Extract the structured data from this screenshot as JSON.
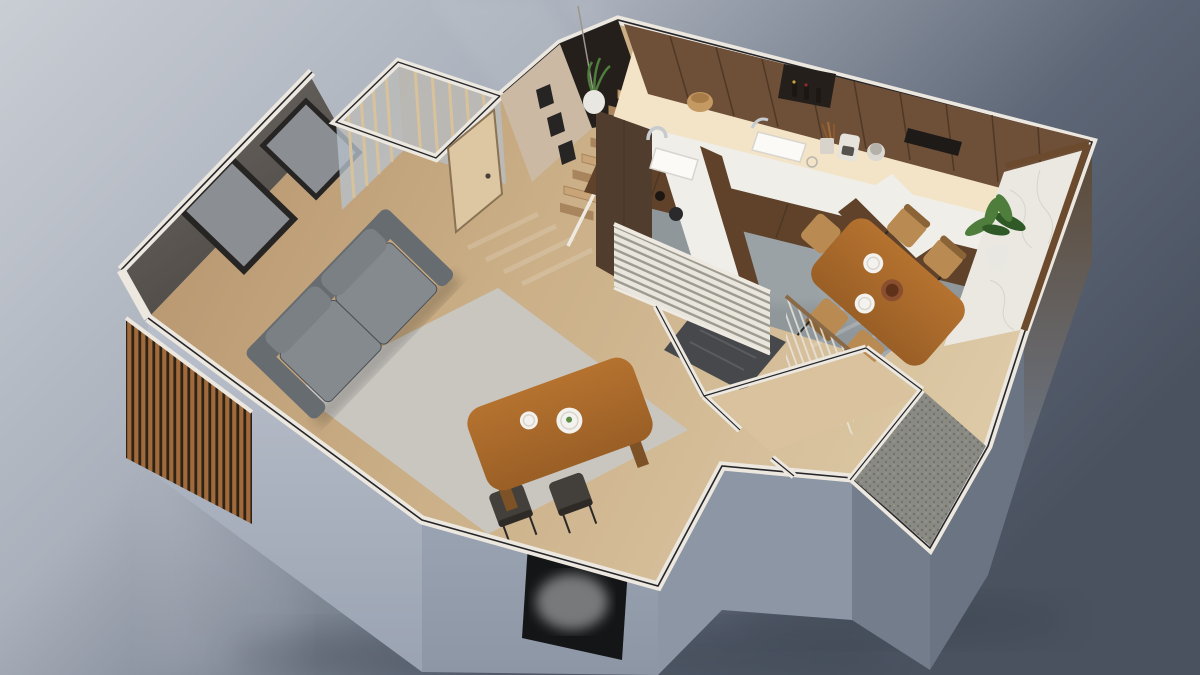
{
  "scene": {
    "type": "3d-isometric-floorplan-render",
    "rooms": [
      "living-room",
      "entry-hall",
      "glass-vestibule",
      "staircase",
      "kitchen",
      "dining-area",
      "entry-nook",
      "porch"
    ],
    "objects": [
      "sofa",
      "area-rug",
      "wall-art-frames",
      "wood-slat-cladding",
      "entry-door",
      "stair-treads",
      "upper-cabinets",
      "u-shaped-counter",
      "kitchen-sink",
      "faucet",
      "coffee-maker",
      "utensil-cup",
      "canister",
      "woven-basket",
      "wine-cubby",
      "marble-ledge",
      "potted-plant",
      "hanging-planter",
      "dining-table",
      "dining-chairs",
      "coffee-plates",
      "louvered-screen",
      "stairwell-void",
      "guard-railing",
      "pebble-doormat",
      "wall-niche",
      "light-switches"
    ]
  },
  "colors": {
    "bg_tl": "#c9cdd4",
    "bg_ml": "#aab1bc",
    "bg_r": "#5d6676",
    "bg_br": "#4a5260",
    "shadow": "#2e3440",
    "beam": "#ffffff",
    "wall_top": "#ece8e0",
    "wall_line": "#26262a",
    "ext_light": "#bac0cb",
    "ext_mid": "#9aa3b2",
    "ext_mid2": "#8d96a5",
    "ext_dark": "#747d8b",
    "ext_dark2": "#6b7482",
    "ext_wood": "#5c4936",
    "niche": "#141517",
    "smoke": "#dcdcdc",
    "switch": "#e8e6e1",
    "floor_w1": "#b3906a",
    "floor_w2": "#c9ad85",
    "floor_w3": "#ddc9a6",
    "rug": "#c9c6c0",
    "feature_wall_1": "#6f6a65",
    "feature_wall_2": "#4b4743",
    "frame_dark": "#272524",
    "frame_inner": "#8b8e92",
    "slat_wood": "#a06a3c",
    "slat_gap": "#2f2316",
    "glass": "#b7c1cc",
    "mullion": "#d8c29c",
    "post": "#eeeae2",
    "wall_tan": "#cbb9a4",
    "door": "#dcc7a2",
    "door_edge": "#8a7355",
    "opening": "#241f1b",
    "stair": "#c9a478",
    "stair_dark": "#a8855c",
    "kfloor": "#8f979b",
    "kfloor_light": "#aab1b3",
    "glow": "#f3e3c7",
    "cab_upper": "#6e4f37",
    "cab_seam": "#4a3522",
    "cab_base": "#5f4229",
    "cab_tall": "#513d2d",
    "counter": "#f0eee8",
    "sink": "#fbfaf6",
    "sink_edge": "#d8d5ce",
    "metal": "#c6cbd0",
    "basket": "#c59a62",
    "bottle": "#1d1713",
    "marble": "#ebe8e1",
    "vein": "#cfccc3",
    "rwall_wood": "#6b4a2e",
    "table": "#b5722f",
    "table_dark": "#9a5f26",
    "leg": "#7d5226",
    "chair_wood": "#b98a52",
    "chair_dark": "#433f3a",
    "plate": "#f4f2ee",
    "garnish": "#5c8d46",
    "bowl": "#8a4f2e",
    "sofa": "#666c70",
    "sofa_light": "#858a8e",
    "sofa_dark": "#4b5055",
    "cushion": "#7b8084",
    "plant": "#4e7d3c",
    "plant_dark": "#2f5a28",
    "pot": "#e9e7e1",
    "screen_slat": "#e9e6de",
    "screen_gap": "#9d9a90",
    "rail_wood": "#8a6a46",
    "void": "#46484b",
    "pebble": "#8a8a84",
    "pebble_dot": "#6f6f68",
    "nook_floor": "#d9c29d",
    "sun_stripe": "#ffffff"
  }
}
